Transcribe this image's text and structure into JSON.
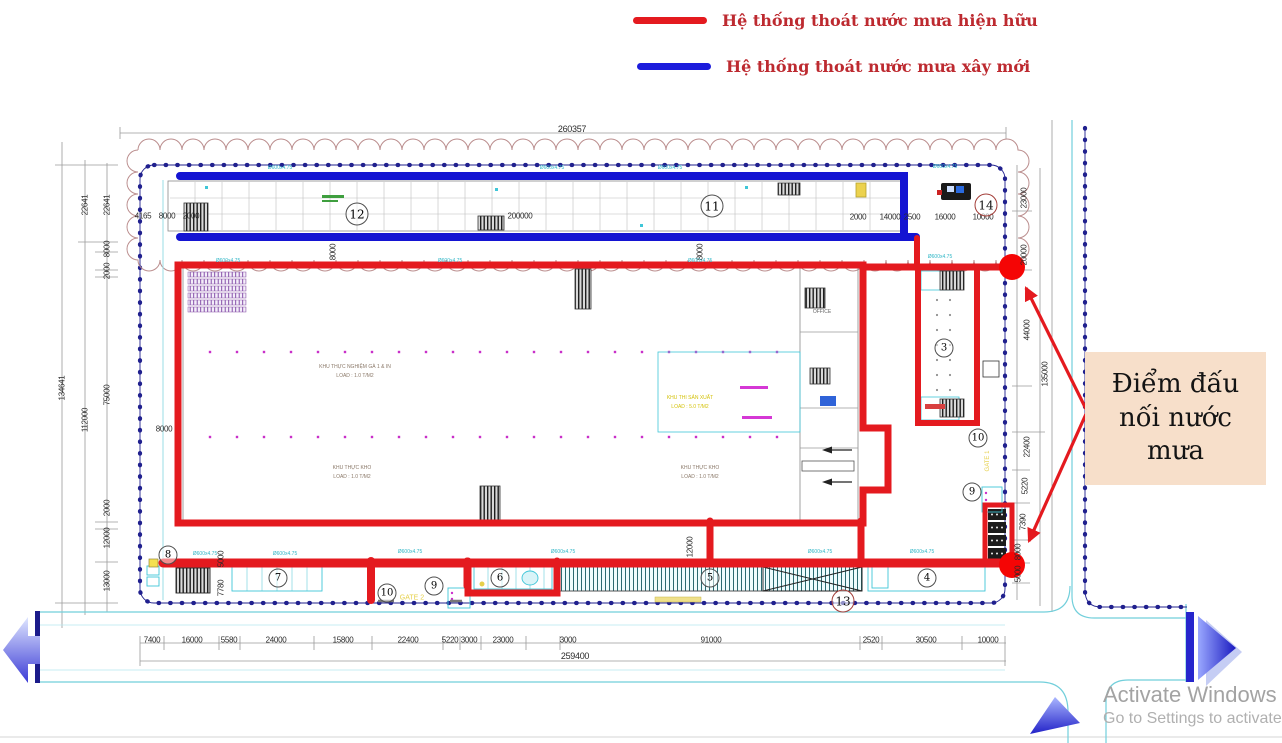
{
  "legend": {
    "items": [
      {
        "label": "Hệ thống thoát nước mưa hiện hữu",
        "color": "#e41a1f"
      },
      {
        "label": "Hệ thống thoát nước mưa xây mới",
        "color": "#1c1cdc"
      }
    ],
    "text_color": "#bd2a30"
  },
  "callout": {
    "text": "Điểm đấu nối nước mưa",
    "bg": "#f7dfca"
  },
  "watermark": {
    "line1": "Activate Windows",
    "line2": "Go to Settings to activate"
  },
  "plan": {
    "colors": {
      "existing_drain": "#e41a1f",
      "new_drain": "#1414d2",
      "boundary": "#20208e",
      "road": "#72cfdb",
      "cloud": "#bb8e8e",
      "connection_dot": "#f50505"
    },
    "dim_total_top": "260357",
    "dim_total_bottom": "259400",
    "top_dims": [
      {
        "t": "4165",
        "x": 143,
        "y": 216
      },
      {
        "t": "8000",
        "x": 167,
        "y": 216
      },
      {
        "t": "2000",
        "x": 191,
        "y": 216
      },
      {
        "t": "200000",
        "x": 520,
        "y": 216
      },
      {
        "t": "2000",
        "x": 858,
        "y": 217
      },
      {
        "t": "14000",
        "x": 890,
        "y": 217
      },
      {
        "t": "2500",
        "x": 912,
        "y": 217
      },
      {
        "t": "16000",
        "x": 945,
        "y": 217
      },
      {
        "t": "10000",
        "x": 983,
        "y": 217
      }
    ],
    "bottom_dims": [
      {
        "t": "7400",
        "x": 152,
        "y": 640
      },
      {
        "t": "16000",
        "x": 192,
        "y": 640
      },
      {
        "t": "5580",
        "x": 229,
        "y": 640
      },
      {
        "t": "24000",
        "x": 276,
        "y": 640
      },
      {
        "t": "15800",
        "x": 343,
        "y": 640
      },
      {
        "t": "22400",
        "x": 408,
        "y": 640
      },
      {
        "t": "5220",
        "x": 450,
        "y": 640
      },
      {
        "t": "3000",
        "x": 469,
        "y": 640
      },
      {
        "t": "23000",
        "x": 503,
        "y": 640
      },
      {
        "t": "3000",
        "x": 568,
        "y": 640
      },
      {
        "t": "91000",
        "x": 711,
        "y": 640
      },
      {
        "t": "2520",
        "x": 871,
        "y": 640
      },
      {
        "t": "30500",
        "x": 926,
        "y": 640
      },
      {
        "t": "10000",
        "x": 988,
        "y": 640
      }
    ],
    "left_dims": [
      {
        "t": "134641",
        "x": 62,
        "y": 388,
        "rot": true
      },
      {
        "t": "22641",
        "x": 85,
        "y": 205,
        "rot": true
      },
      {
        "t": "112000",
        "x": 85,
        "y": 420,
        "rot": true
      },
      {
        "t": "22641",
        "x": 107,
        "y": 205,
        "rot": true
      },
      {
        "t": "8000",
        "x": 107,
        "y": 249,
        "rot": true
      },
      {
        "t": "2000",
        "x": 107,
        "y": 271,
        "rot": true
      },
      {
        "t": "75000",
        "x": 107,
        "y": 395,
        "rot": true
      },
      {
        "t": "2000",
        "x": 107,
        "y": 508,
        "rot": true
      },
      {
        "t": "12000",
        "x": 107,
        "y": 538,
        "rot": true
      },
      {
        "t": "13000",
        "x": 107,
        "y": 581,
        "rot": true
      }
    ],
    "right_dims": [
      {
        "t": "23000",
        "x": 1024,
        "y": 198,
        "rot": true
      },
      {
        "t": "20000",
        "x": 1024,
        "y": 255,
        "rot": true
      },
      {
        "t": "44000",
        "x": 1027,
        "y": 330,
        "rot": true
      },
      {
        "t": "135000",
        "x": 1045,
        "y": 374,
        "rot": true
      },
      {
        "t": "22400",
        "x": 1027,
        "y": 447,
        "rot": true
      },
      {
        "t": "5220",
        "x": 1025,
        "y": 486,
        "rot": true
      },
      {
        "t": "7390",
        "x": 1023,
        "y": 522,
        "rot": true
      },
      {
        "t": "8000",
        "x": 1018,
        "y": 552,
        "rot": true
      },
      {
        "t": "5000",
        "x": 1018,
        "y": 574,
        "rot": true
      }
    ],
    "extra_dims": [
      {
        "t": "8000",
        "x": 164,
        "y": 429,
        "rot": false
      },
      {
        "t": "8000",
        "x": 333,
        "y": 252,
        "rot": true
      },
      {
        "t": "8000",
        "x": 700,
        "y": 252,
        "rot": true
      },
      {
        "t": "12000",
        "x": 690,
        "y": 547,
        "rot": true
      },
      {
        "t": "5000",
        "x": 221,
        "y": 559,
        "rot": true
      },
      {
        "t": "7780",
        "x": 221,
        "y": 588,
        "rot": true
      }
    ],
    "circles": [
      {
        "n": "3",
        "x": 944,
        "y": 348,
        "red": false,
        "big": false
      },
      {
        "n": "4",
        "x": 927,
        "y": 578,
        "red": false,
        "big": false
      },
      {
        "n": "5",
        "x": 710,
        "y": 578,
        "red": false,
        "big": false
      },
      {
        "n": "6",
        "x": 500,
        "y": 578,
        "red": false,
        "big": false
      },
      {
        "n": "7",
        "x": 278,
        "y": 578,
        "red": false,
        "big": false
      },
      {
        "n": "8",
        "x": 168,
        "y": 555,
        "red": false,
        "big": false
      },
      {
        "n": "9",
        "x": 434,
        "y": 586,
        "red": false,
        "big": false
      },
      {
        "n": "10",
        "x": 387,
        "y": 593,
        "red": false,
        "big": false
      },
      {
        "n": "9",
        "x": 972,
        "y": 492,
        "red": false,
        "big": false
      },
      {
        "n": "10",
        "x": 978,
        "y": 438,
        "red": false,
        "big": false
      },
      {
        "n": "11",
        "x": 712,
        "y": 206,
        "red": false,
        "big": true
      },
      {
        "n": "12",
        "x": 357,
        "y": 214,
        "red": false,
        "big": true
      },
      {
        "n": "13",
        "x": 843,
        "y": 601,
        "red": true,
        "big": true
      },
      {
        "n": "14",
        "x": 986,
        "y": 205,
        "red": true,
        "big": true
      }
    ],
    "labels": [
      {
        "t": "KHU THỰC NGHIỆM GÀ 1 & IN",
        "x": 355,
        "y": 367,
        "c": "#8a7868",
        "s": 5,
        "rot": false
      },
      {
        "t": "LOAD : 1.0 T/M2",
        "x": 355,
        "y": 376,
        "c": "#8a7868",
        "s": 5,
        "rot": false
      },
      {
        "t": "KHU THỰC KHO",
        "x": 352,
        "y": 468,
        "c": "#8a7868",
        "s": 5,
        "rot": false
      },
      {
        "t": "LOAD : 1.0 T/M2",
        "x": 352,
        "y": 477,
        "c": "#8a7868",
        "s": 5,
        "rot": false
      },
      {
        "t": "KHU THỰC KHO",
        "x": 700,
        "y": 468,
        "c": "#8a7868",
        "s": 5,
        "rot": false
      },
      {
        "t": "LOAD : 1.0 T/M2",
        "x": 700,
        "y": 477,
        "c": "#8a7868",
        "s": 5,
        "rot": false
      },
      {
        "t": "KHU THI SẢN XUẤT",
        "x": 690,
        "y": 398,
        "c": "#d4c20a",
        "s": 5,
        "rot": false
      },
      {
        "t": "LOAD : 5.0 T/M2",
        "x": 690,
        "y": 407,
        "c": "#d4c20a",
        "s": 5,
        "rot": false
      },
      {
        "t": "OFFICE",
        "x": 822,
        "y": 312,
        "c": "#666666",
        "s": 5,
        "rot": false
      },
      {
        "t": "GATE 2",
        "x": 412,
        "y": 598,
        "c": "#e6d04a",
        "s": 7,
        "rot": false
      },
      {
        "t": "GATE 1",
        "x": 988,
        "y": 461,
        "c": "#e6d04a",
        "s": 6,
        "rot": true
      }
    ],
    "pipe_label": "Ø600x4.75",
    "pipe_positions": [
      [
        280,
        168
      ],
      [
        552,
        168
      ],
      [
        670,
        168
      ],
      [
        945,
        167
      ],
      [
        228,
        261
      ],
      [
        450,
        261
      ],
      [
        700,
        261
      ],
      [
        940,
        257
      ],
      [
        205,
        554
      ],
      [
        285,
        554
      ],
      [
        410,
        552
      ],
      [
        563,
        552
      ],
      [
        820,
        552
      ],
      [
        922,
        552
      ]
    ]
  }
}
